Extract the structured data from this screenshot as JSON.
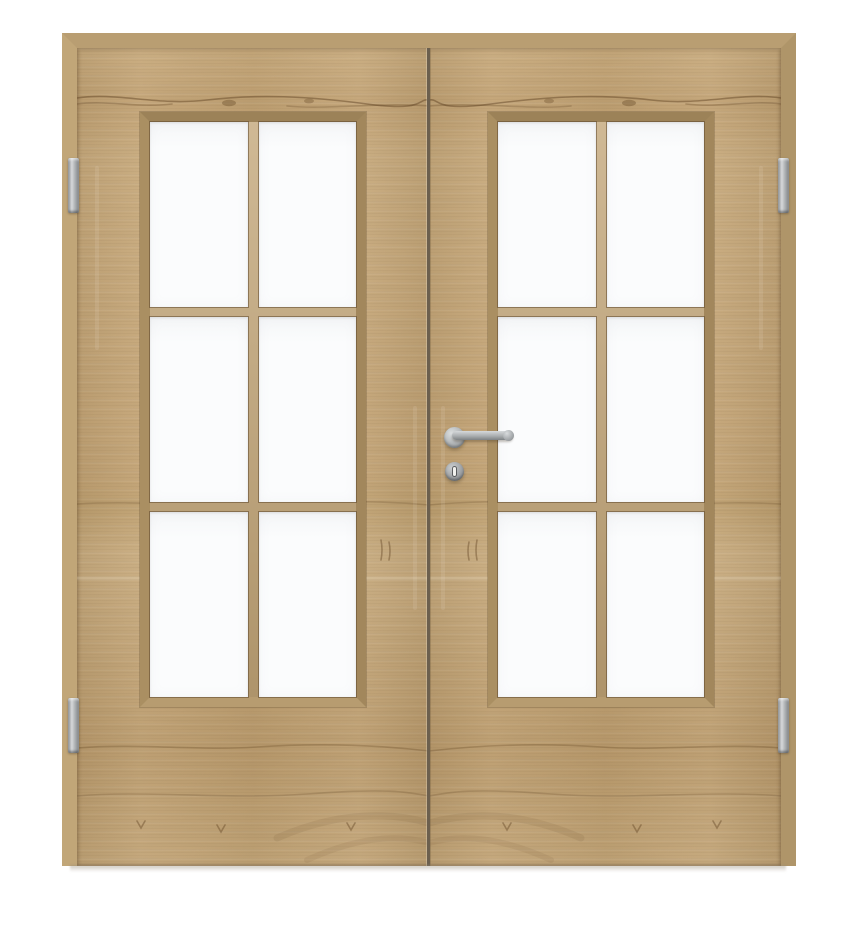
{
  "scene": {
    "description": "Product photo of a closed light-oak double interior door with white background",
    "door_leaves": 2,
    "panes_per_leaf": 6,
    "pane_rows": 3,
    "pane_columns": 2,
    "hinge_count": 4,
    "handle": "stainless steel straight lever on round rosette, right leaf near meeting stile",
    "escutcheon": "round stainless key escutcheon with vertical profile-cylinder slot below lever",
    "glazing": "clear white glass with flat wooden muntin bars",
    "frame": "narrow wooden frame with mitred top corners, no bottom sill"
  },
  "colors": {
    "background": "#ffffff",
    "wood_base": "#c3a577",
    "wood_dark": "#8a7048",
    "frame_head": "#b99e72",
    "frame_left": "#c1a678",
    "frame_right": "#af9569",
    "bevel_top": "#9c8258",
    "bevel_left": "#aa8f62",
    "bevel_right": "#a2875c",
    "bevel_bottom": "#b79c70",
    "muntin": "#c2a577",
    "glass": "#fbfcfd",
    "gap_line": "#6b5f4e",
    "metal_light": "#d6d8da",
    "metal_dark": "#7f8285",
    "keyhole_slot": "#f2f2ef"
  }
}
